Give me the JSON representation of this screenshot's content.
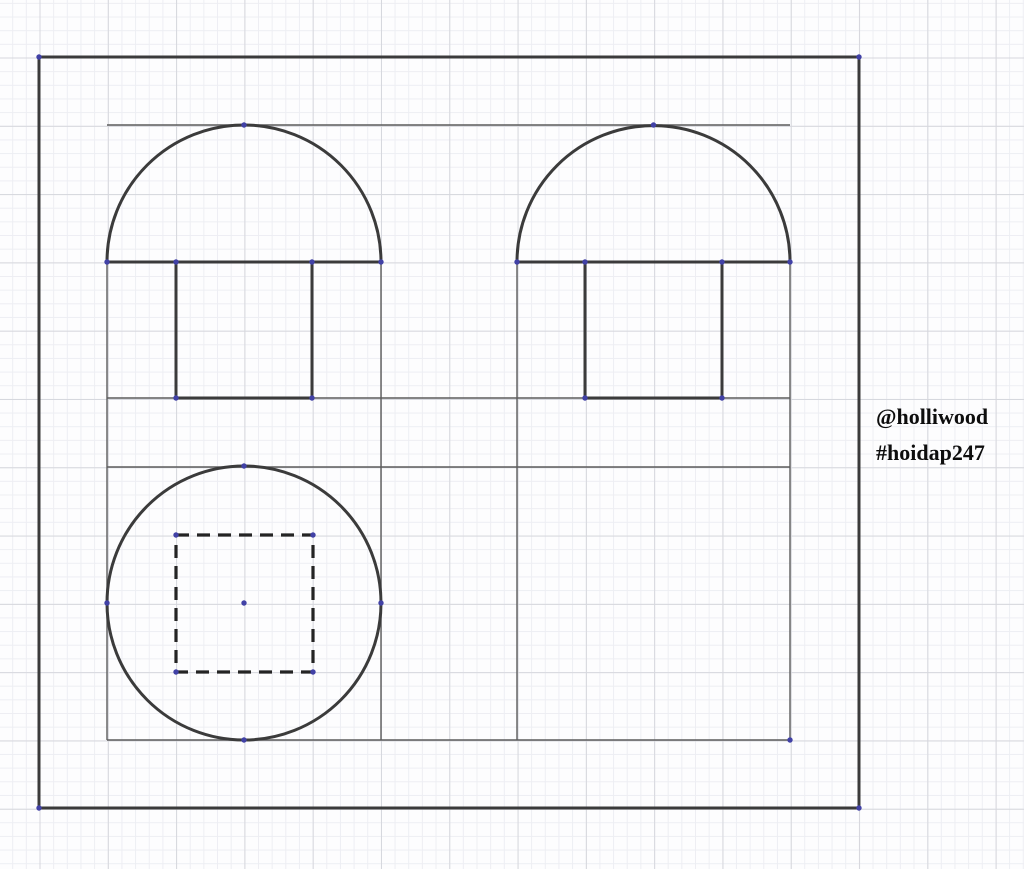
{
  "canvas": {
    "width": 1024,
    "height": 869,
    "paper_color": "#fdfdfe",
    "grid": {
      "minor_spacing": 13.66,
      "major_spacing": 68.3,
      "origin_x": 39,
      "origin_y": 57,
      "minor_color": "#edeef3",
      "major_color": "#d6d7dd"
    }
  },
  "watermark": {
    "line1": "@holliwood",
    "line2": "#hoidap247",
    "color": "#0d0d0d"
  },
  "drawing": {
    "thick": {
      "color": "#3b3b3b",
      "width": 3
    },
    "thin": {
      "color": "#5c5c5c",
      "width": 1.4
    },
    "dashed": {
      "color": "#242424",
      "width": 3.2,
      "dash": "13 8"
    },
    "point": {
      "color": "#4141a6",
      "radius": 2.7
    },
    "thin_lines": [
      [
        107,
        125,
        790,
        125
      ],
      [
        107,
        398,
        790,
        398
      ],
      [
        107,
        467,
        790,
        467
      ],
      [
        107,
        740,
        790,
        740
      ],
      [
        107,
        262,
        107,
        740
      ],
      [
        381,
        262,
        381,
        740
      ],
      [
        517,
        262,
        517,
        740
      ],
      [
        790,
        262,
        790,
        740
      ]
    ],
    "thick_lines": [
      [
        39,
        57,
        859,
        57
      ],
      [
        859,
        57,
        859,
        808
      ],
      [
        39,
        808,
        859,
        808
      ],
      [
        39,
        57,
        39,
        808
      ],
      [
        107,
        262,
        381,
        262
      ],
      [
        517,
        262,
        790,
        262
      ],
      [
        176,
        262,
        176,
        398
      ],
      [
        176,
        398,
        312,
        398
      ],
      [
        312,
        398,
        312,
        262
      ],
      [
        585,
        262,
        585,
        398
      ],
      [
        585,
        398,
        722,
        398
      ],
      [
        722,
        398,
        722,
        262
      ]
    ],
    "arcs": [
      {
        "cx": 244,
        "cy": 262,
        "r": 137
      },
      {
        "cx": 653.5,
        "cy": 262,
        "r": 136.5
      }
    ],
    "circles": [
      {
        "cx": 244,
        "cy": 603,
        "r": 137
      }
    ],
    "dashed_rects": [
      {
        "x": 176,
        "y": 535,
        "w": 137,
        "h": 137
      }
    ],
    "points": [
      [
        39,
        57
      ],
      [
        859,
        57
      ],
      [
        859,
        808
      ],
      [
        39,
        808
      ],
      [
        244,
        125
      ],
      [
        653.5,
        125
      ],
      [
        107,
        262
      ],
      [
        381,
        262
      ],
      [
        517,
        262
      ],
      [
        790,
        262
      ],
      [
        176,
        262
      ],
      [
        312,
        262
      ],
      [
        585,
        262
      ],
      [
        722,
        262
      ],
      [
        176,
        398
      ],
      [
        312,
        398
      ],
      [
        585,
        398
      ],
      [
        722,
        398
      ],
      [
        244,
        466
      ],
      [
        244,
        740
      ],
      [
        107,
        603
      ],
      [
        381,
        603
      ],
      [
        244,
        603
      ],
      [
        176,
        535
      ],
      [
        313,
        535
      ],
      [
        176,
        672
      ],
      [
        313,
        672
      ],
      [
        790,
        740
      ]
    ]
  }
}
